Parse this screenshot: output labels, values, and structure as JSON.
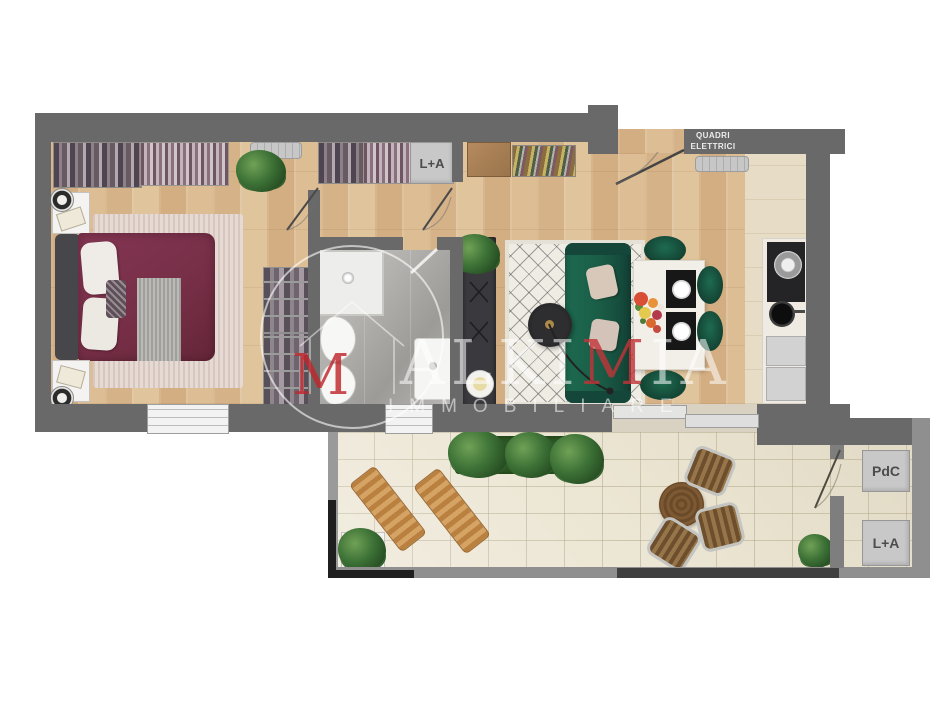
{
  "floorplan": {
    "labels": {
      "hall_laundry": "L+A",
      "electrical_line1": "QUADRI",
      "electrical_line2": "ELETTRICI",
      "heat_pump": "PdC",
      "terrace_laundry": "L+A"
    },
    "watermark": {
      "logo_letter": "M",
      "brand_pre": "ALKI",
      "brand_m": "M",
      "brand_post": "IA",
      "subtitle": "IMMOBILIARE"
    },
    "colors": {
      "wall": "#696969",
      "terrace_wall": "#9a9a9a",
      "wood_floor": "#d8b78c",
      "kitchen_floor": "#e7dcc6",
      "bathroom_floor": "#b0aeab",
      "terrace_tile": "#ece6d4",
      "bed": "#7b3048",
      "sofa_green": "#1a5c46",
      "dining_chair_green": "#15503c",
      "tv_unit": "#3a3a3e",
      "lounger_wood": "#c9924f",
      "brand_red": "#c23439",
      "label_box": "#c8c8c8"
    }
  }
}
